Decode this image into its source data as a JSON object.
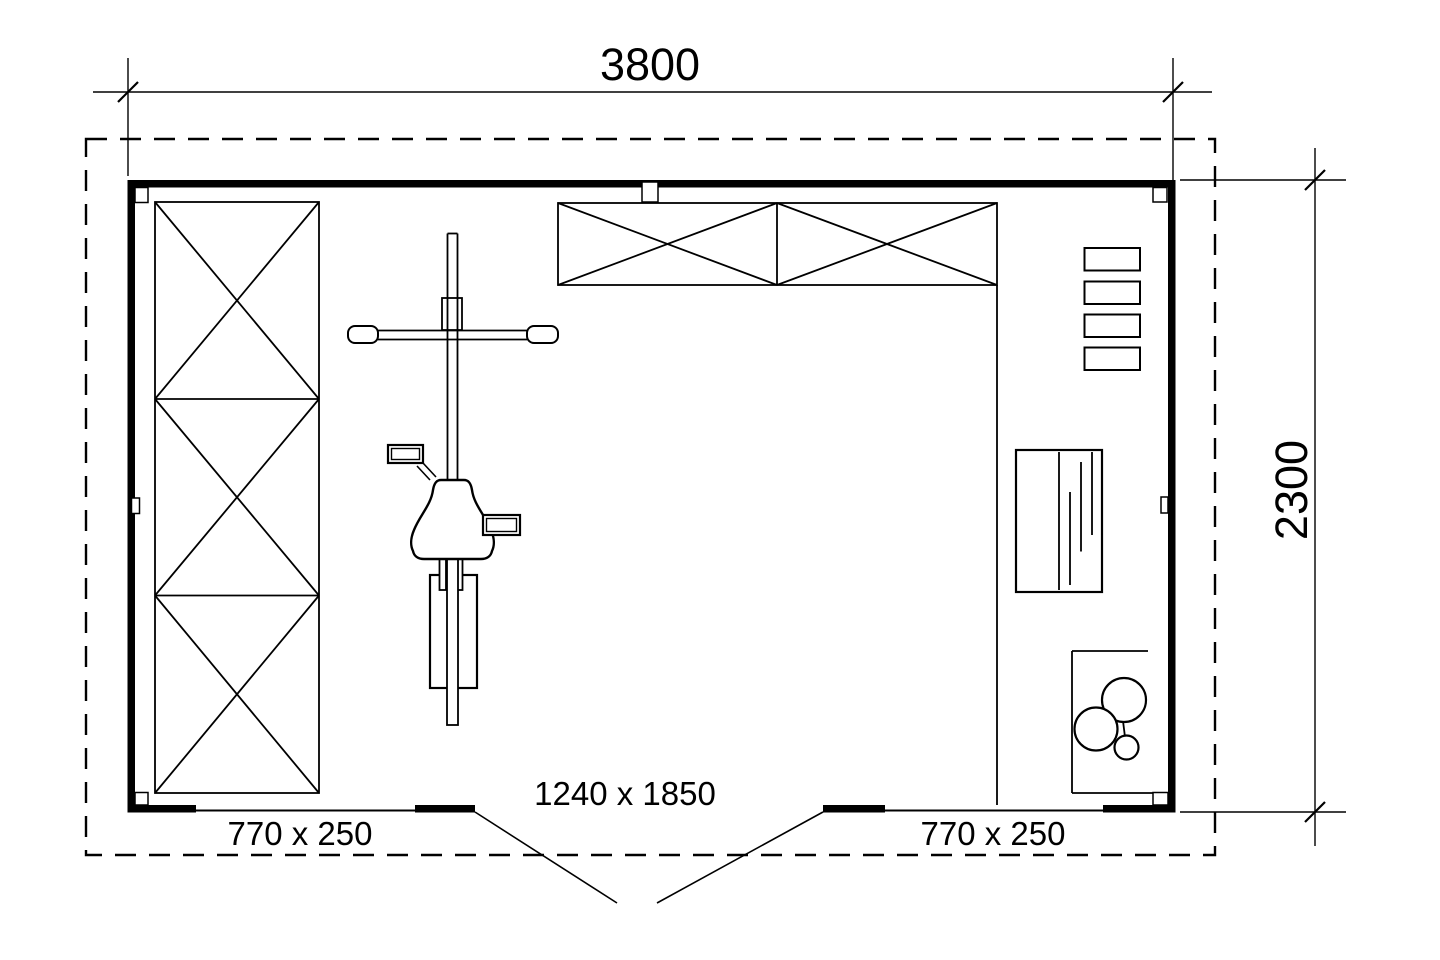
{
  "title": "Shed floor plan",
  "colors": {
    "ink": "#000000",
    "paper": "#ffffff"
  },
  "dimensions": {
    "overall_width_mm": "3800",
    "overall_depth_mm": "2300"
  },
  "labels": {
    "window_left": "770 x 250",
    "window_right": "770 x 250",
    "door": "1240 x 1850"
  }
}
